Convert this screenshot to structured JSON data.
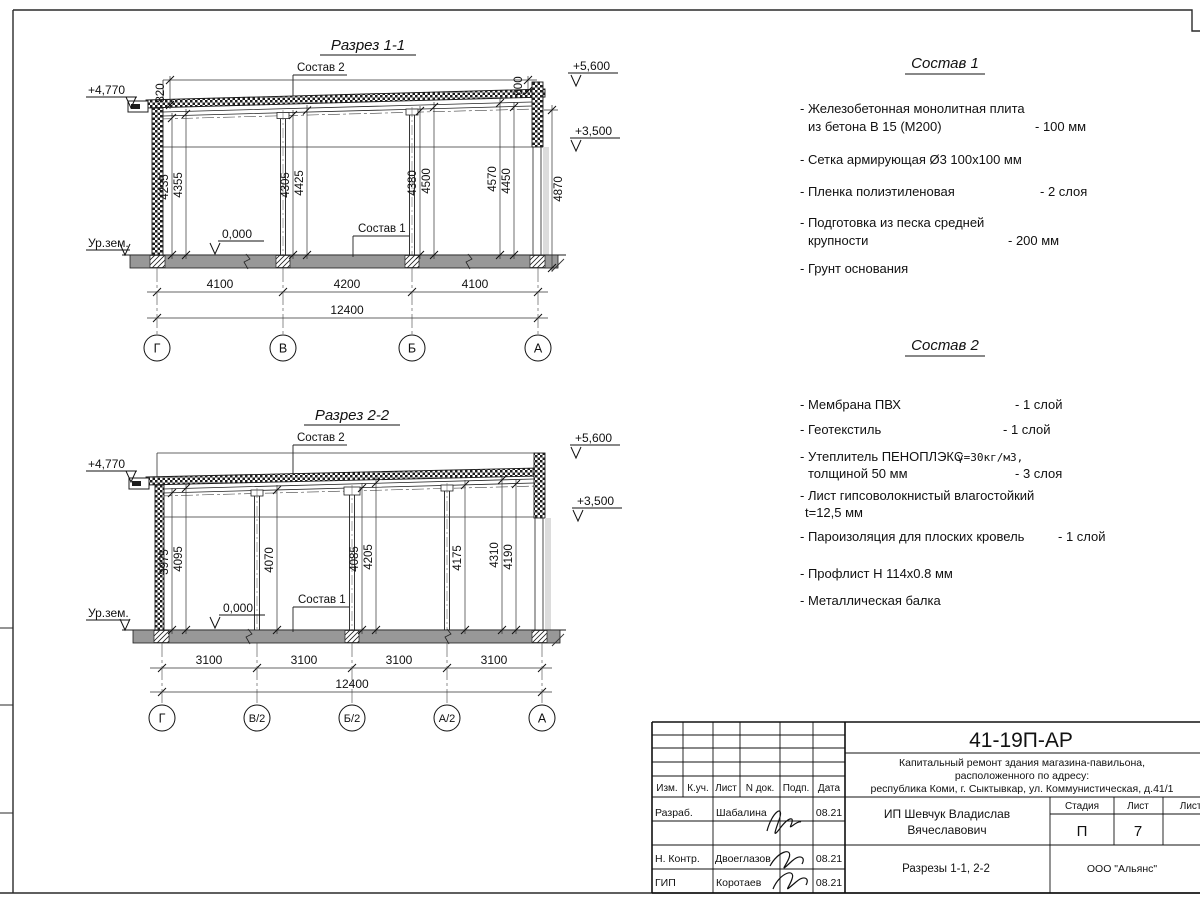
{
  "s1": {
    "title": "Разрез 1-1",
    "label_sostav1": "Состав 1",
    "label_sostav2": "Состав 2",
    "elev_left": "+4,770",
    "elev_top": "+5,600",
    "elev_mid": "+3,500",
    "elev_zero": "0,000",
    "ground": "Ур.зем.",
    "dim_left_top": "820",
    "dim_right_top": "600",
    "dim_right": "4870",
    "v": [
      "4235",
      "4355",
      "4305",
      "4425",
      "4380",
      "4500",
      "4570",
      "4450"
    ],
    "b": [
      "4100",
      "4200",
      "4100"
    ],
    "total": "12400",
    "axes": [
      "Г",
      "В",
      "Б",
      "А"
    ]
  },
  "s2": {
    "title": "Разрез 2-2",
    "label_sostav1": "Состав 1",
    "label_sostav2": "Состав 2",
    "elev_left": "+4,770",
    "elev_top": "+5,600",
    "elev_mid": "+3,500",
    "elev_zero": "0,000",
    "ground": "Ур.зем.",
    "v": [
      "3975",
      "4095",
      "4070",
      "4085",
      "4205",
      "4175",
      "4310",
      "4190"
    ],
    "b": [
      "3100",
      "3100",
      "3100",
      "3100"
    ],
    "total": "12400",
    "axes": [
      "Г",
      "В/2",
      "Б/2",
      "А/2",
      "А"
    ]
  },
  "sostav1": {
    "title": "Состав 1",
    "lines": [
      {
        "t": "- Железобетонная  монолитная плита"
      },
      {
        "t": "из бетона В 15 (М200)",
        "v": "- 100 мм"
      },
      {
        "t": "- Сетка армирующая Ø3 100x100 мм"
      },
      {
        "t": "- Пленка полиэтиленовая",
        "v": "- 2 слоя"
      },
      {
        "t": "- Подготовка из песка средней"
      },
      {
        "t": "крупности",
        "v": "- 200 мм"
      },
      {
        "t": "- Грунт основания"
      }
    ]
  },
  "sostav2": {
    "title": "Состав 2",
    "lines": [
      {
        "t": "- Мембрана ПВХ",
        "v": "- 1 слой"
      },
      {
        "t": "- Геотекстиль",
        "v": "- 1 слой"
      },
      {
        "t": "- Утеплитель ПЕНОПЛЭКС",
        "g": "γ=30кг/м3,"
      },
      {
        "t": "толщиной 50 мм",
        "v": "- 3 слоя"
      },
      {
        "t": "- Лист гипсоволокнистый влагостойкий"
      },
      {
        "t": "t=12,5 мм"
      },
      {
        "t": "- Пароизоляция для плоских кровель",
        "v": "- 1 слой"
      },
      {
        "t": "- Профлист Н 114х0.8 мм"
      },
      {
        "t": "- Металлическая балка"
      }
    ]
  },
  "tb": {
    "doc": "41-19П-АР",
    "desc1": "Капитальный ремонт здания магазина-павильона,",
    "desc2": "расположенного по адресу:",
    "desc3": "республика Коми, г. Сыктывкар, ул. Коммунистическая, д.41/1",
    "col_izm": "Изм.",
    "col_kuch": "К.уч.",
    "col_list": "Лист",
    "col_ndok": "N док.",
    "col_podp": "Подп.",
    "col_data": "Дата",
    "row1_role": "Разраб.",
    "row1_name": "Шабалина",
    "row1_date": "08.21",
    "row2_role": "Н. Контр.",
    "row2_name": "Двоеглазов",
    "row2_date": "08.21",
    "row3_role": "ГИП",
    "row3_name": "Коротаев",
    "row3_date": "08.21",
    "client1": "ИП Шевчук Владислав",
    "client2": "Вячеславович",
    "stage_h": "Стадия",
    "sheet_h": "Лист",
    "sheets_h": "Листов",
    "stage": "П",
    "sheet": "7",
    "subtitle": "Разрезы 1-1, 2-2",
    "org": "ООО \"Альянс\""
  }
}
